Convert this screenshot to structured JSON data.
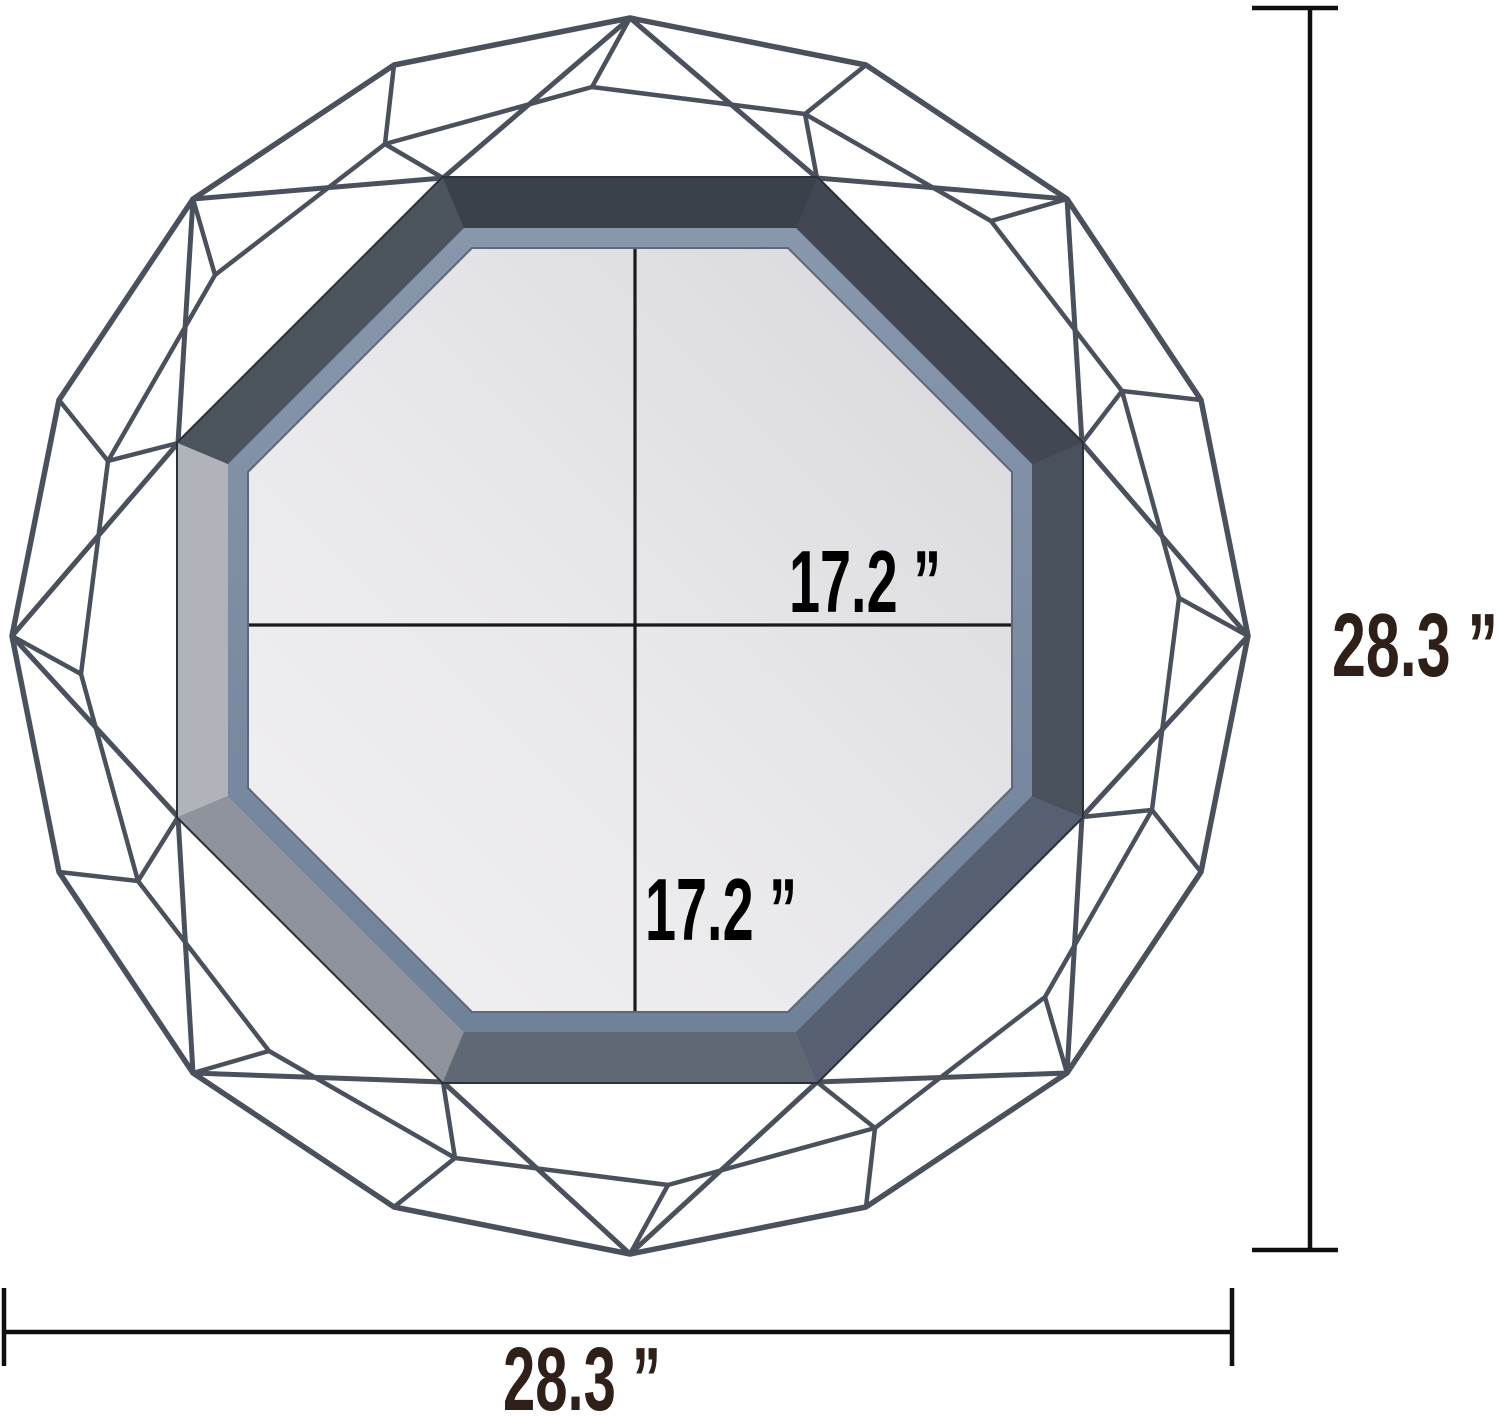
{
  "page": {
    "type": "product-dimension-diagram",
    "subject": "octagonal geometric wire-frame wall mirror",
    "background": "#ffffff"
  },
  "labels": {
    "mirror_width": "17.2 ”",
    "mirror_height": "17.2 ”",
    "overall_height": "28.3 ”",
    "overall_width": "28.3 ”"
  },
  "values": {
    "mirror_width_in": 17.2,
    "mirror_height_in": 17.2,
    "overall_width_in": 28.3,
    "overall_height_in": 28.3,
    "unit": "inch"
  },
  "colors": {
    "wire": "#4b515c",
    "frame_face": "#3f4650",
    "frame_lip": "#7d8da2",
    "mirror": "#e7e6e9",
    "crosshair": "#1a1a1a",
    "dimension_line": "#0f0f0f",
    "mirror_label_text": "#000000",
    "overall_label_text": "#2e2018"
  }
}
